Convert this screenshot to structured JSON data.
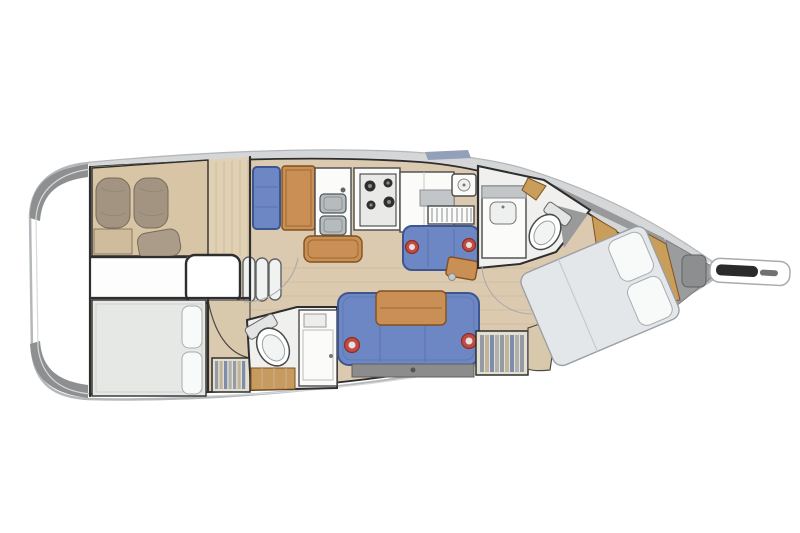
{
  "scene": {
    "type": "sailing-yacht interior floor plan, top-down architectural drawing",
    "orientation": "bow pointing right, stern (rounded transom) on the left",
    "visible_text": "none"
  },
  "colors": {
    "hull_fill": "#ffffff",
    "hull_outline": "#b5b8ba",
    "hull_inner_line": "#d7d9db",
    "stern_shadow": "#8e8f91",
    "deck_band": "#d4d6d8",
    "hatch_blue": "#93a0ba",
    "floor_wood": "#dccab0",
    "floor_plank": "#cdb897",
    "cabin_floor_wood": "#e0d0b4",
    "wall": "#2e2e2e",
    "upholstery_blue": "#6d87c4",
    "upholstery_blue_dark": "#3e568f",
    "upholstery_line": "#5a72ad",
    "wood": "#c98f54",
    "wood_dark": "#81511f",
    "wood_light": "#c99e5a",
    "mattress_tan": "#d8c5a6",
    "pillow_brown": "#a39482",
    "pillow_brown_dark": "#776b5b",
    "pillow_texture": "#8d8172",
    "cushion_brown": "#ab9c8a",
    "bed_white": "#e6e8e6",
    "bed_fwd": "#e4e7ea",
    "pillow_white": "#f8f9f9",
    "fixture_white": "#fbfbfa",
    "fixture_line": "#4a4a4a",
    "steel": "#b6bbbe",
    "steel_dark": "#50565a",
    "burner_dark": "#2f2f2f",
    "head_floor": "#f0f1ef",
    "shower_gray": "#9a9a9b",
    "bow_shade": "#98999b",
    "red_accent": "#c14b42",
    "red_accent_dark": "#8d2d26",
    "beige_seat": "#d9c9ac",
    "locker_bg": "#e4dfd3",
    "stripe_1": "#949ba3",
    "stripe_2": "#c0b59a",
    "stripe_3": "#7d8dac",
    "stripe_4": "#b0b0ae",
    "anchor_gray": "#9b9c9e",
    "chain_gray": "#8d8e90",
    "roller_black": "#2a2a2a",
    "sofa_base": "#8c8c8c",
    "step_white": "#f0f1f1",
    "arc_gray": "#a8a8a8"
  },
  "areas": [
    {
      "name": "aft-port-cabin",
      "furniture": [
        "double-berth",
        "rolled-pillow",
        "rolled-pillow",
        "cushion",
        "wood-floor"
      ]
    },
    {
      "name": "aft-starboard-cabin",
      "furniture": [
        "double-berth",
        "headboard-cushion",
        "headboard-cushion"
      ]
    },
    {
      "name": "companionway",
      "furniture": [
        "landing",
        "three-steps"
      ]
    },
    {
      "name": "aft-head",
      "furniture": [
        "toilet",
        "vanity-cabinet",
        "wood-floor"
      ]
    },
    {
      "name": "nav-station",
      "furniture": [
        "seat",
        "chart-table"
      ]
    },
    {
      "name": "galley",
      "furniture": [
        "double-sink",
        "stove",
        "worktop-island",
        "refrigerator-counter",
        "dish-rack",
        "hand-sink"
      ]
    },
    {
      "name": "saloon",
      "furniture": [
        "port-settee",
        "corner-table",
        "main-sofa",
        "dining-table",
        "round-cushion",
        "round-cushion",
        "storage-base",
        "hanging-locker",
        "hanging-locker",
        "curved-seat",
        "curved-seat",
        "mast-post"
      ]
    },
    {
      "name": "forward-head",
      "furniture": [
        "vanity-with-sink",
        "toilet",
        "shower-floor",
        "wood-trim"
      ]
    },
    {
      "name": "forward-cabin",
      "furniture": [
        "angled-double-berth",
        "pillow",
        "pillow",
        "wood-trim-band",
        "wood-trim-band"
      ]
    },
    {
      "name": "bow",
      "furniture": [
        "anchor-locker",
        "anchor-chain",
        "bowsprit",
        "anchor-roller"
      ]
    }
  ]
}
